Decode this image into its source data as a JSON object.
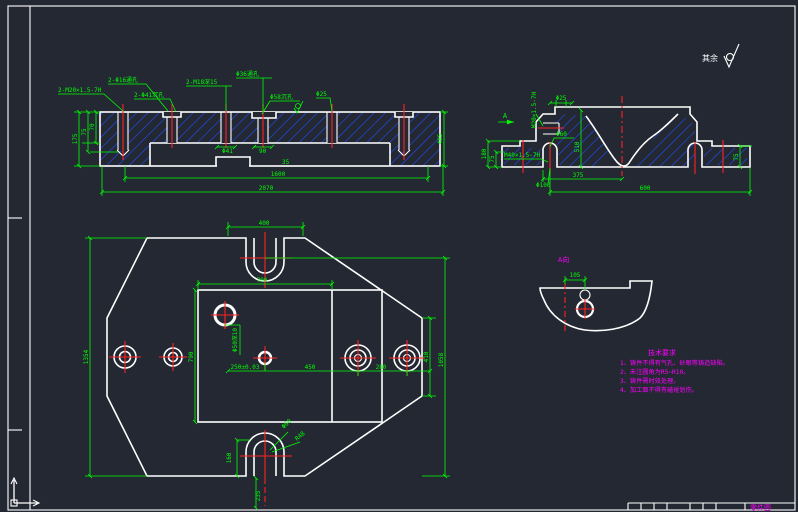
{
  "colors": {
    "background": "#232833",
    "line": "#ffffff",
    "dimension": "#00ff00",
    "centerline": "#ff2222",
    "hatch": "#2050ff",
    "note": "#ff00ff"
  },
  "surface_note": {
    "text": "其余"
  },
  "front_section": {
    "callouts": {
      "tap_left": "2-M20×1.5-7H",
      "thru_16": "2-Φ16通孔",
      "cbore_41": "2-Φ41沉孔",
      "tap_m18": "2-M18深15",
      "thru_36": "Φ36通孔",
      "cbore_58": "Φ58沉孔",
      "dia_25": "Φ25"
    },
    "dims": {
      "h175": "175",
      "h75": "75",
      "h70": "70",
      "h485": "485",
      "dia41": "Φ41",
      "w90": "90",
      "w35": "35",
      "len1600": "1600",
      "len2070": "2070"
    }
  },
  "side_section": {
    "view_arrow": "A",
    "callouts": {
      "dia25": "Φ25",
      "tap_vert": "M20×1.5-7H",
      "tap_m40": "M40×1.5-7H",
      "dia60": "Φ60",
      "dia100": "Φ100"
    },
    "dims": {
      "h180": "180",
      "h75": "75",
      "h510": "510",
      "w375": "375",
      "w600": "600",
      "h75r": "75"
    }
  },
  "plan_view": {
    "dims": {
      "w400": "400",
      "w700": "700",
      "h1354": "1354",
      "h790": "790",
      "h410": "410",
      "h1058": "1058",
      "w280": "280",
      "w450": "450",
      "w250": "250±0.03",
      "hole_note": "Φ50深10",
      "h160": "160",
      "dia60": "Φ60",
      "r48": "R48",
      "h235": "235"
    }
  },
  "a_view": {
    "label": "A向",
    "dim105": "105"
  },
  "tech_requirements": {
    "title": "技术要求",
    "items": [
      "1、铸件不得有气孔、砂眼等铸造缺陷。",
      "2、未注圆角为R5~R10。",
      "3、铸件需时效处理。",
      "4、加工面不得有磕碰划伤。"
    ]
  },
  "title_block": {
    "label": "零件图"
  }
}
